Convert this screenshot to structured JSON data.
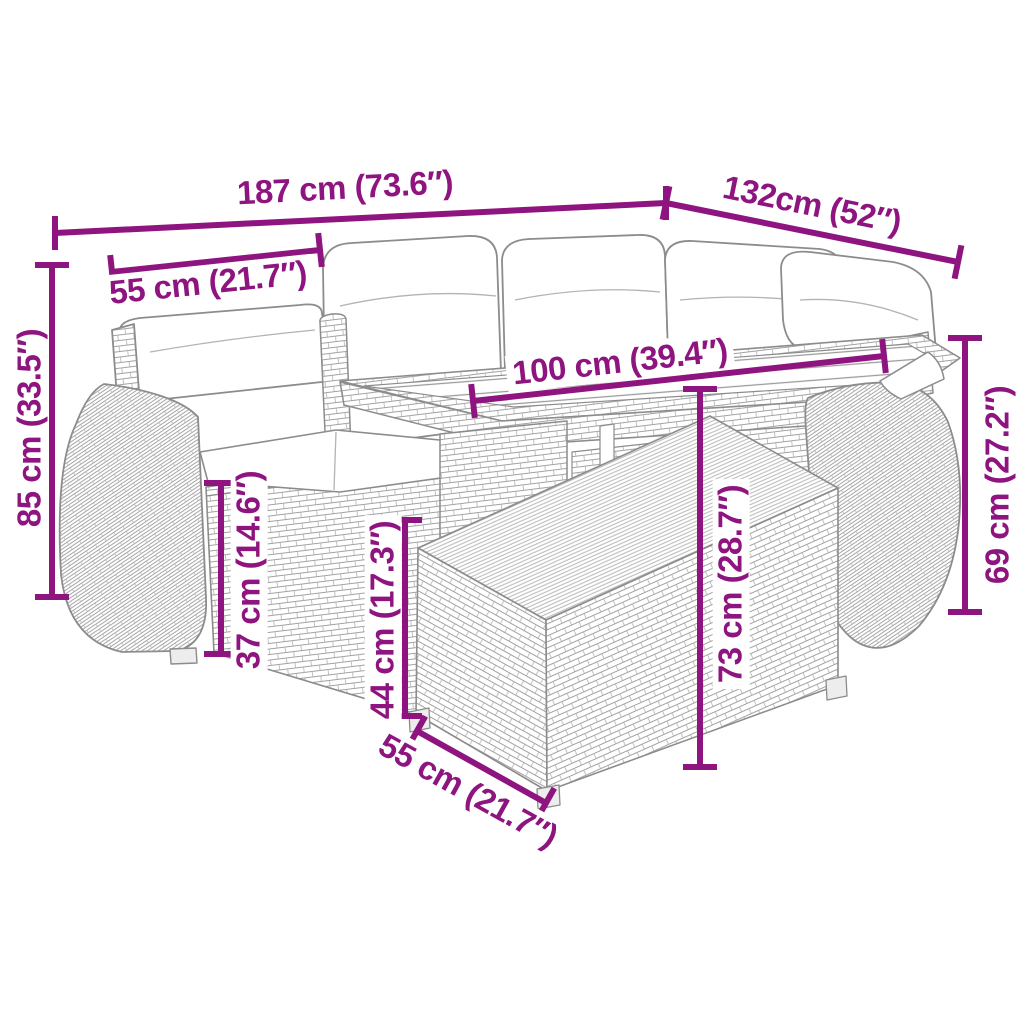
{
  "diagram": {
    "background": "#ffffff",
    "accent_color": "#8E1480",
    "line_color": "#8c8c8c",
    "figure": "Gray rattan corner sofa set with cushions, slatted-top table and base, drawn as line art",
    "dimensions": [
      {
        "id": "sofa-width",
        "label": "187 cm (73.6″)"
      },
      {
        "id": "sofa-depth",
        "label": "132cm (52″)"
      },
      {
        "id": "seat-width",
        "label": "55 cm (21.7″)"
      },
      {
        "id": "sofa-height",
        "label": "85 cm (33.5″)"
      },
      {
        "id": "table-length",
        "label": "100 cm (39.4″)"
      },
      {
        "id": "armrest-height",
        "label": "69 cm (27.2″)"
      },
      {
        "id": "seat-height",
        "label": "37 cm (14.6″)"
      },
      {
        "id": "base-height",
        "label": "44 cm (17.3″)"
      },
      {
        "id": "table-height",
        "label": "73 cm (28.7″)"
      },
      {
        "id": "base-depth",
        "label": "55 cm (21.7″)"
      }
    ]
  }
}
